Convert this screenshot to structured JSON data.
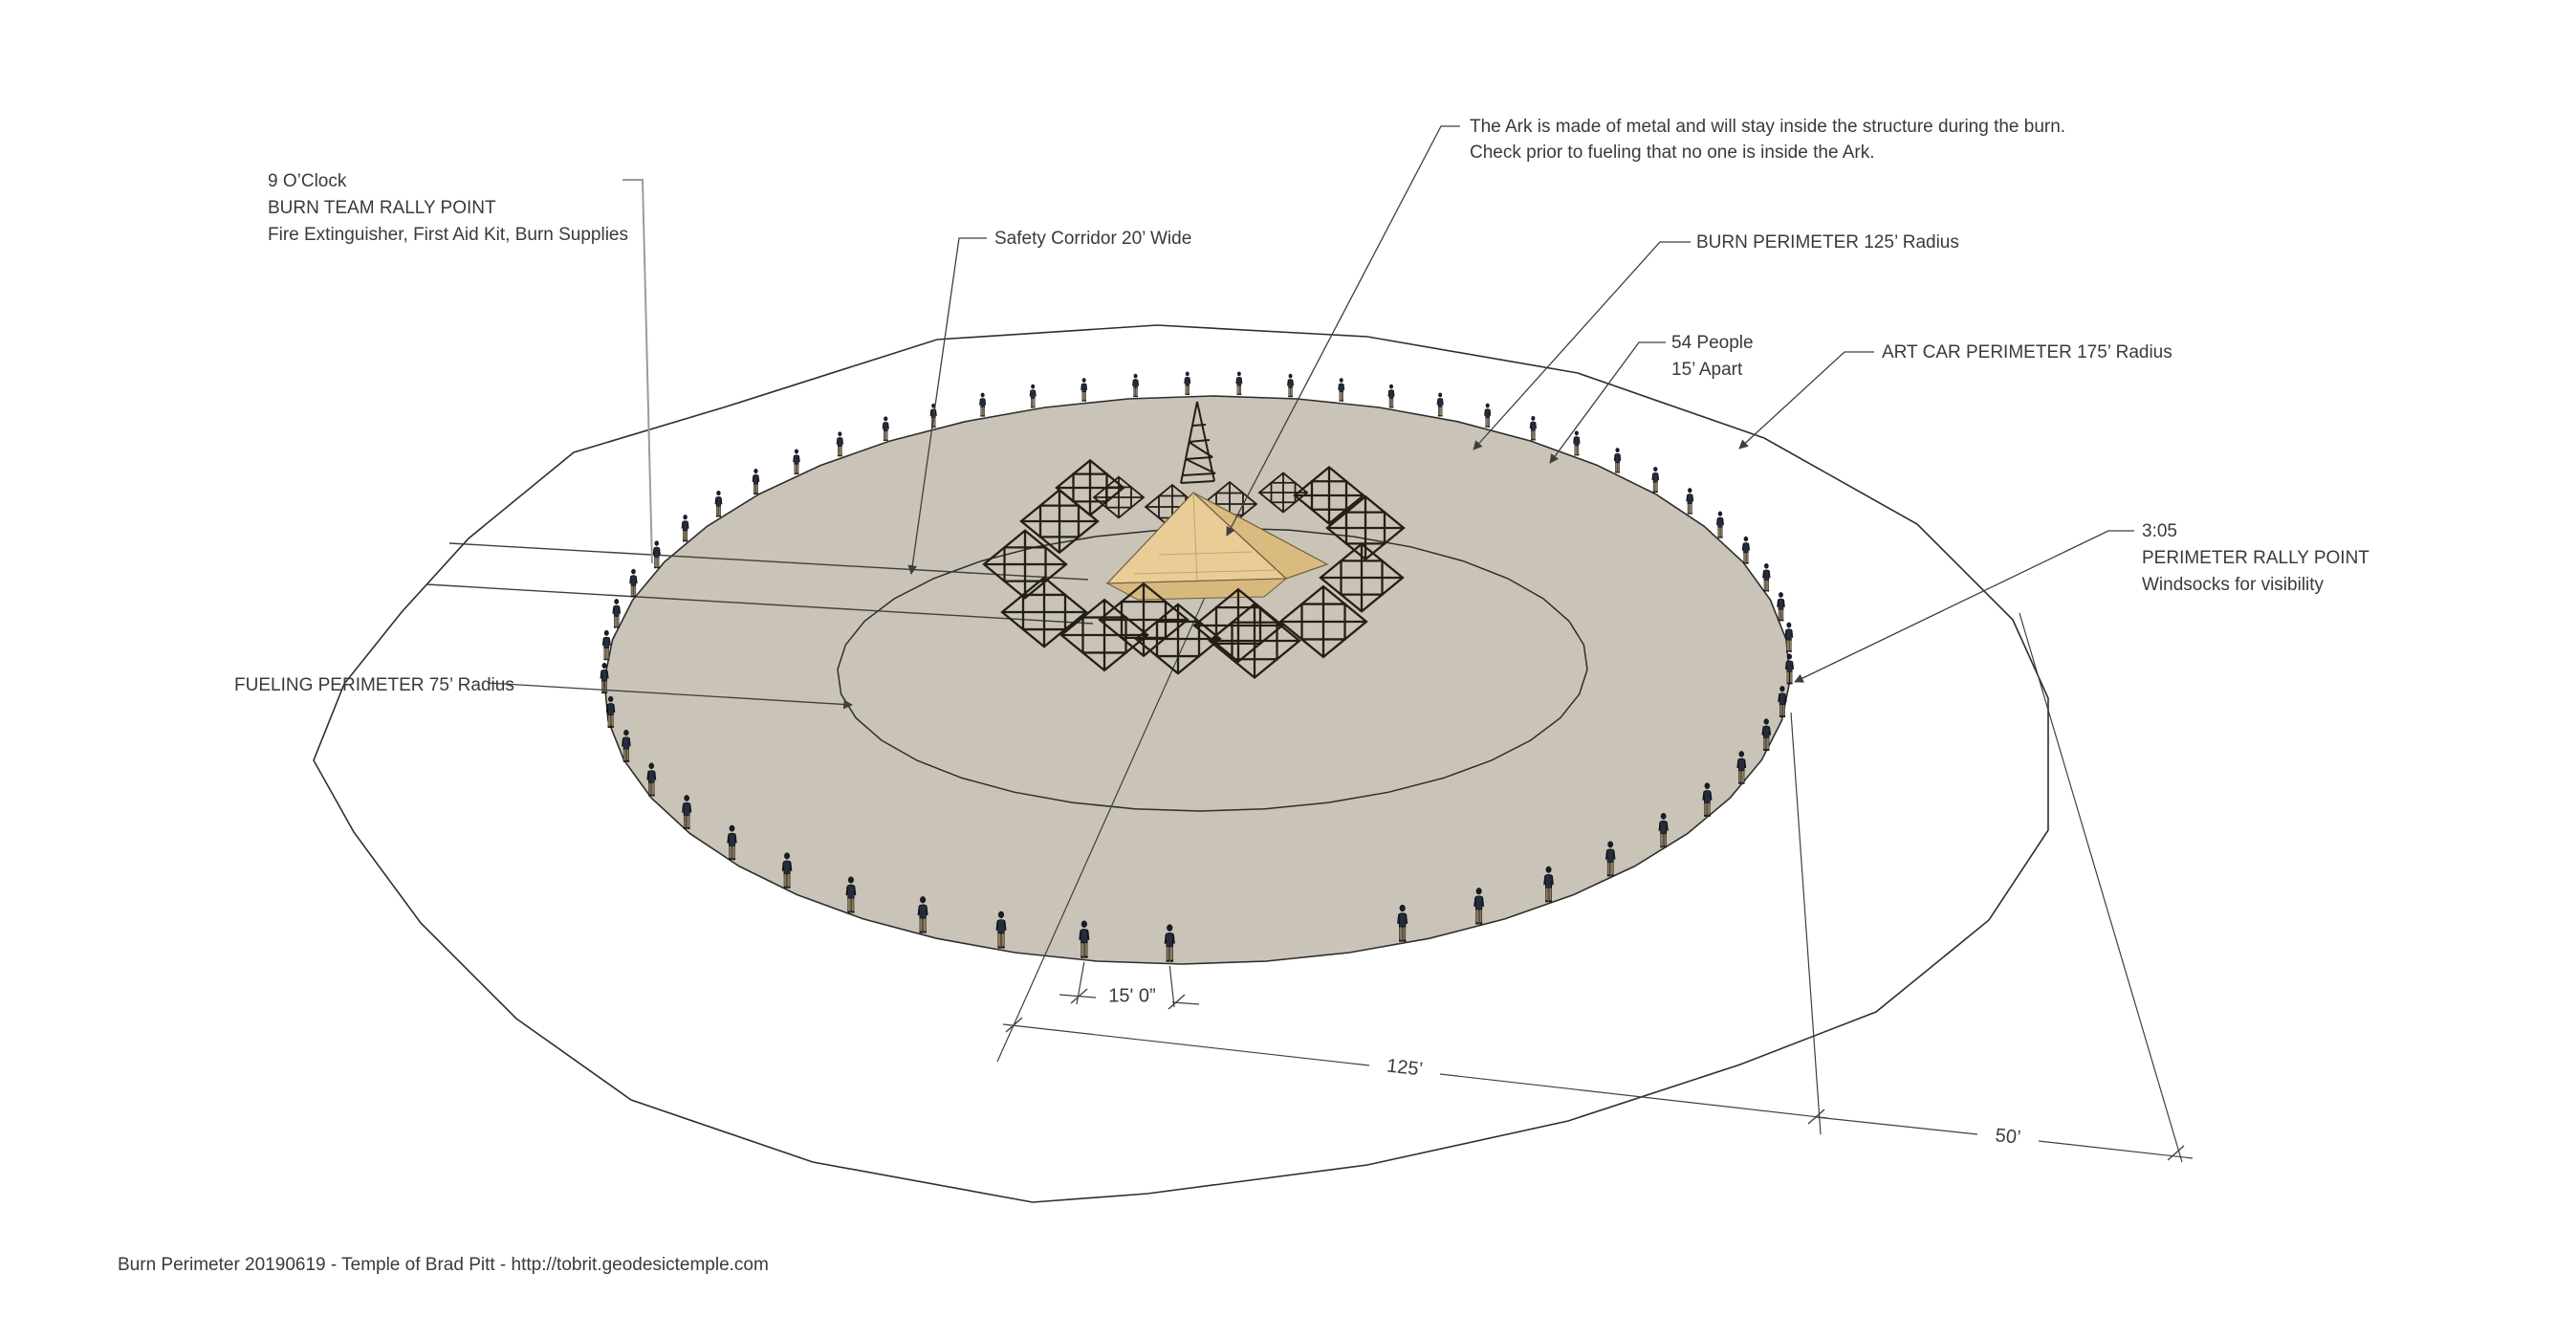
{
  "labels": {
    "rally_9": {
      "line1": "9 O’Clock",
      "line2": "BURN TEAM RALLY POINT",
      "line3": "Fire Extinguisher, First Aid Kit, Burn Supplies"
    },
    "safety_corridor": "Safety Corridor 20’ Wide",
    "ark_note": {
      "line1": "The Ark is made of metal and will stay inside the structure during the burn.",
      "line2": "Check prior to fueling that no one is inside the Ark."
    },
    "burn_perimeter": "BURN PERIMETER 125’ Radius",
    "people": {
      "line1": "54 People",
      "line2": "15’ Apart"
    },
    "art_car_perimeter": "ART CAR PERIMETER 175’ Radius",
    "rally_305": {
      "line1": "3:05",
      "line2": "PERIMETER RALLY POINT",
      "line3": "Windsocks for visibility"
    },
    "fueling_perimeter": "FUELING PERIMETER 75’ Radius"
  },
  "dimensions": {
    "spacing": "15' 0”",
    "burn_radius": "125’",
    "art_car_offset": "50’"
  },
  "figures": {
    "count": 54
  },
  "footer": "Burn Perimeter 20190619 - Temple of Brad Pitt - http://tobrit.geodesictemple.com",
  "colors": {
    "background": "#ffffff",
    "burn_area_fill": "#cac3b7",
    "outline": "#2e2e2e",
    "line": "#3f3f3f",
    "gray_leader": "#9b9b9b",
    "text": "#3a3a3a",
    "figure_jacket": "#252c3c",
    "figure_pants": "#8c7b5c",
    "pyramid_front": "#e9cc96",
    "pyramid_side": "#d9bb80",
    "truss": "#241f16"
  }
}
